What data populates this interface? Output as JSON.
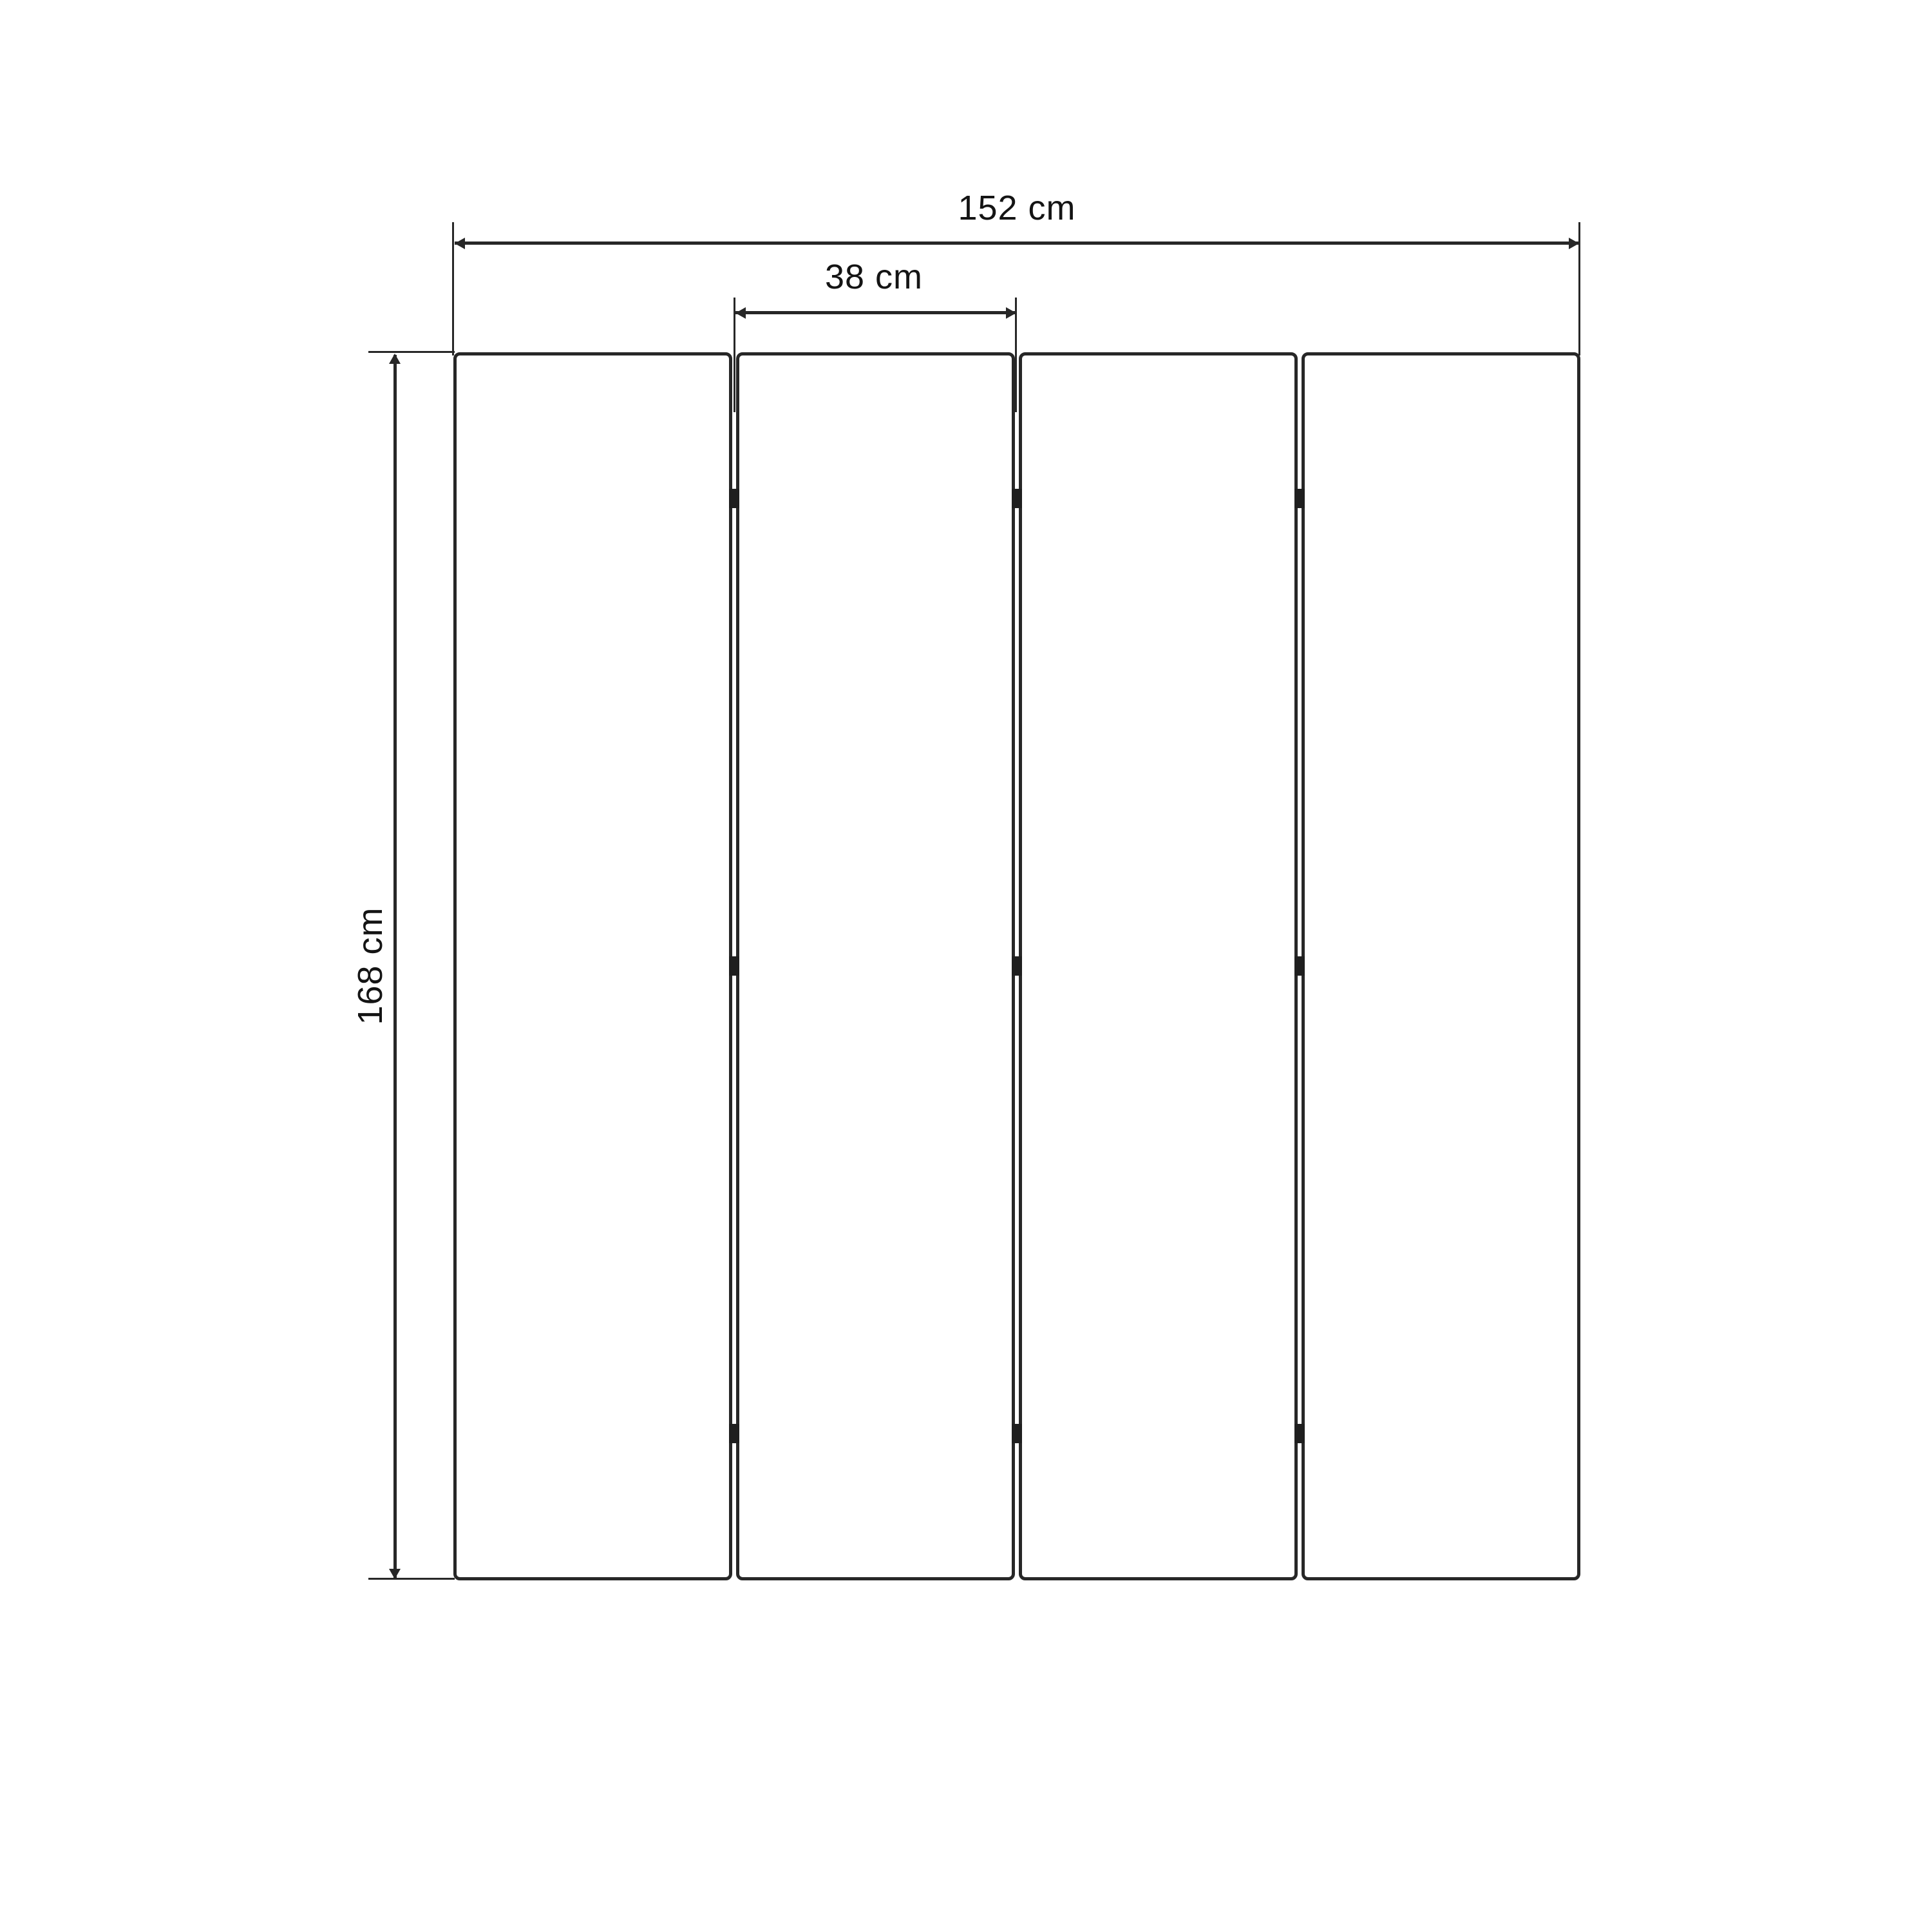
{
  "diagram": {
    "type": "dimension-drawing",
    "subject": "four-panel folding screen, front elevation",
    "panel_count": 4,
    "hinge_rows": 3,
    "dimensions": {
      "total_width": {
        "label": "152 cm",
        "value": 152,
        "unit": "cm"
      },
      "panel_width": {
        "label": "38 cm",
        "value": 38,
        "unit": "cm"
      },
      "height": {
        "label": "168 cm",
        "value": 168,
        "unit": "cm"
      }
    },
    "icons": {
      "arrowheads": [
        "left",
        "right",
        "up",
        "down"
      ]
    },
    "colors": {
      "stroke": "#272727",
      "hinge": "#1f1f1f",
      "text": "#141414",
      "background": "#ffffff"
    }
  }
}
